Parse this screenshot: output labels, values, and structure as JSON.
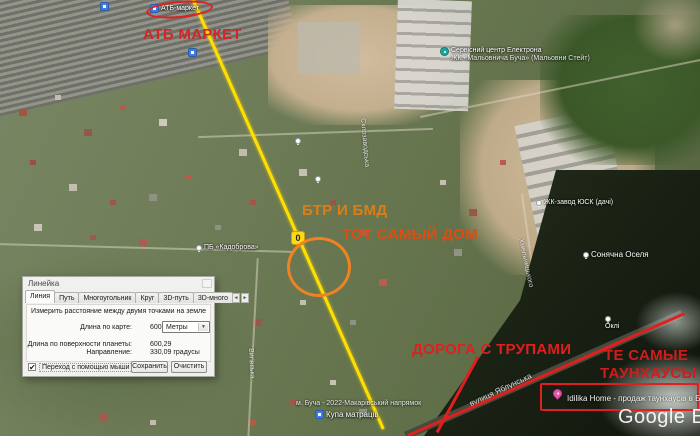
{
  "colors": {
    "annotation_red": "#e01f1f",
    "annotation_orange": "#e07c14",
    "annotation_red_orange": "#e04c10",
    "ruler_yellow": "#ffdf00",
    "placemark_pink": "#e856ae"
  },
  "glyphs": {
    "check": "✔",
    "dropdown_arrow": "▼",
    "tab_scroll_left": "◄",
    "tab_scroll_right": "►"
  },
  "map": {
    "watermark": "Google Ea",
    "pois": {
      "atb_store": "АТБ-маркет",
      "service_center_line1": "Сервісний центр Електрона",
      "service_center_line2": "ЖК «Мальовнича Буча» (Мальовни Стейт)",
      "usk": "ЖК-завод ЮСК (дачі)",
      "sonyachna": "Сонячна Оселя",
      "okli": "Оклі",
      "kadobrova": "ПБ «Кадоброва»",
      "mattresses": "Купа матраців",
      "bucha_note": "м. Буча - 2022-Макарівський напрямок"
    },
    "streets": {
      "yablunska": "вулиця Яблунська",
      "sklozavodska": "Склозаводська",
      "vyhivska": "Вигівська",
      "khmelnytskoho": "Хмельницького"
    }
  },
  "annotations": {
    "atb": "АТБ МАРКЕТ",
    "btr": "БТР И БМД",
    "house": "ТОТ САМЫЙ ДОМ",
    "corpses_road": "ДОРОГА С ТРУПАМИ",
    "townhouses_line1": "ТЕ САМЫЕ",
    "townhouses_line2": "ТАУНХАУСЫ",
    "ruler_zero": "0"
  },
  "placemark": {
    "label": "Idilika Home - продаж таунхаусів в Бучі"
  },
  "ruler_dialog": {
    "title": "Линейка",
    "tabs": [
      "Линия",
      "Путь",
      "Многоугольник",
      "Круг",
      "3D-путь",
      "3D-много"
    ],
    "description": "Измерить расстояние между двумя точками на земле",
    "map_length_label": "Длина по карте:",
    "map_length_value": "600,24",
    "unit_selected": "Метры",
    "ground_length_label": "Длина по поверхности планеты:",
    "ground_length_value": "600,29",
    "heading_label": "Направление:",
    "heading_value": "330,09 градусы",
    "mouse_nav_label": "Переход с помощью мыши",
    "save_button": "Сохранить",
    "clear_button": "Очистить"
  }
}
